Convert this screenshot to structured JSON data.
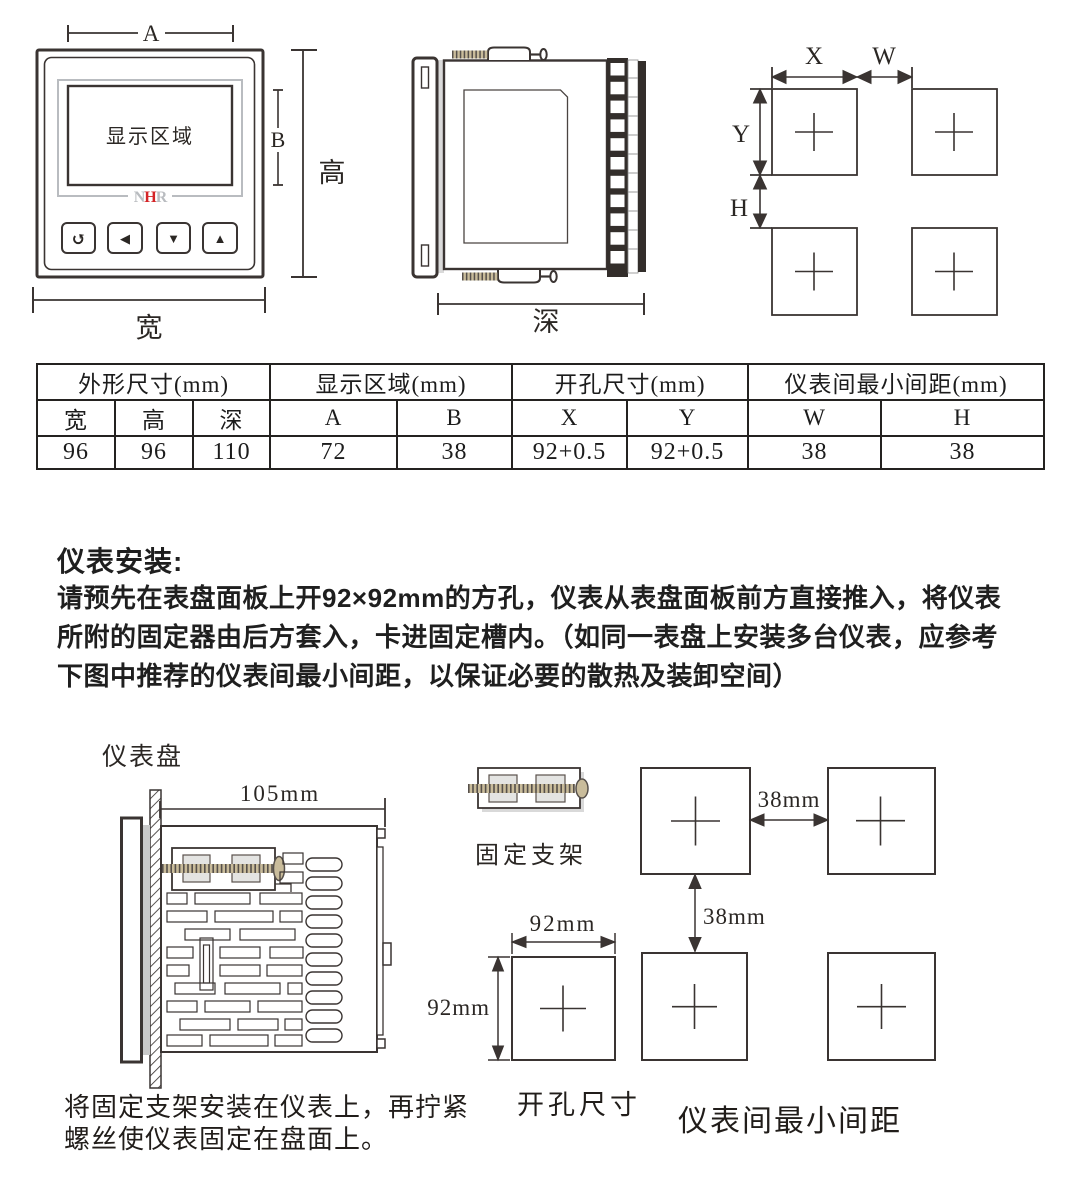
{
  "front_view": {
    "dim_a": "A",
    "dim_b": "B",
    "dim_height": "高",
    "dim_width": "宽",
    "display_label": "显示区域",
    "logo": {
      "n": "N",
      "h": "H",
      "r": "R",
      "gray_color": "#b9bcc0",
      "red_color": "#d42427"
    },
    "buttons": {
      "back": "↺",
      "left": "◀",
      "down": "▼",
      "up": "▲"
    }
  },
  "side_view": {
    "dim_depth": "深"
  },
  "cutout_view": {
    "dim_x": "X",
    "dim_w": "W",
    "dim_y": "Y",
    "dim_h": "H"
  },
  "dimension_table": {
    "groups": [
      {
        "label": "外形尺寸(mm)",
        "span": 3
      },
      {
        "label": "显示区域(mm)",
        "span": 2
      },
      {
        "label": "开孔尺寸(mm)",
        "span": 2
      },
      {
        "label": "仪表间最小间距(mm)",
        "span": 2
      }
    ],
    "columns": [
      "宽",
      "高",
      "深",
      "A",
      "B",
      "X",
      "Y",
      "W",
      "H"
    ],
    "values": [
      "96",
      "96",
      "110",
      "72",
      "38",
      "92+0.5",
      "92+0.5",
      "38",
      "38"
    ]
  },
  "installation": {
    "heading": "仪表安装:",
    "lines": [
      "请预先在表盘面板上开92×92mm的方孔，仪表从表盘面板前方直接推入，将仪表",
      "所附的固定器由后方套入，卡进固定槽内。（如同一表盘上安装多台仪表，应参考",
      "下图中推荐的仪表间最小间距，以保证必要的散热及装卸空间）"
    ]
  },
  "mounting": {
    "panel_label": "仪表盘",
    "body_depth": "105mm",
    "bracket_label": "固定支架",
    "cutout_w": "92mm",
    "cutout_h": "92mm",
    "gap_horizontal": "38mm",
    "gap_vertical": "38mm",
    "cutout_caption": "开孔尺寸",
    "spacing_caption": "仪表间最小间距",
    "note_lines": [
      "将固定支架安装在仪表上，再拧紧",
      "螺丝使仪表固定在盘面上。"
    ]
  }
}
